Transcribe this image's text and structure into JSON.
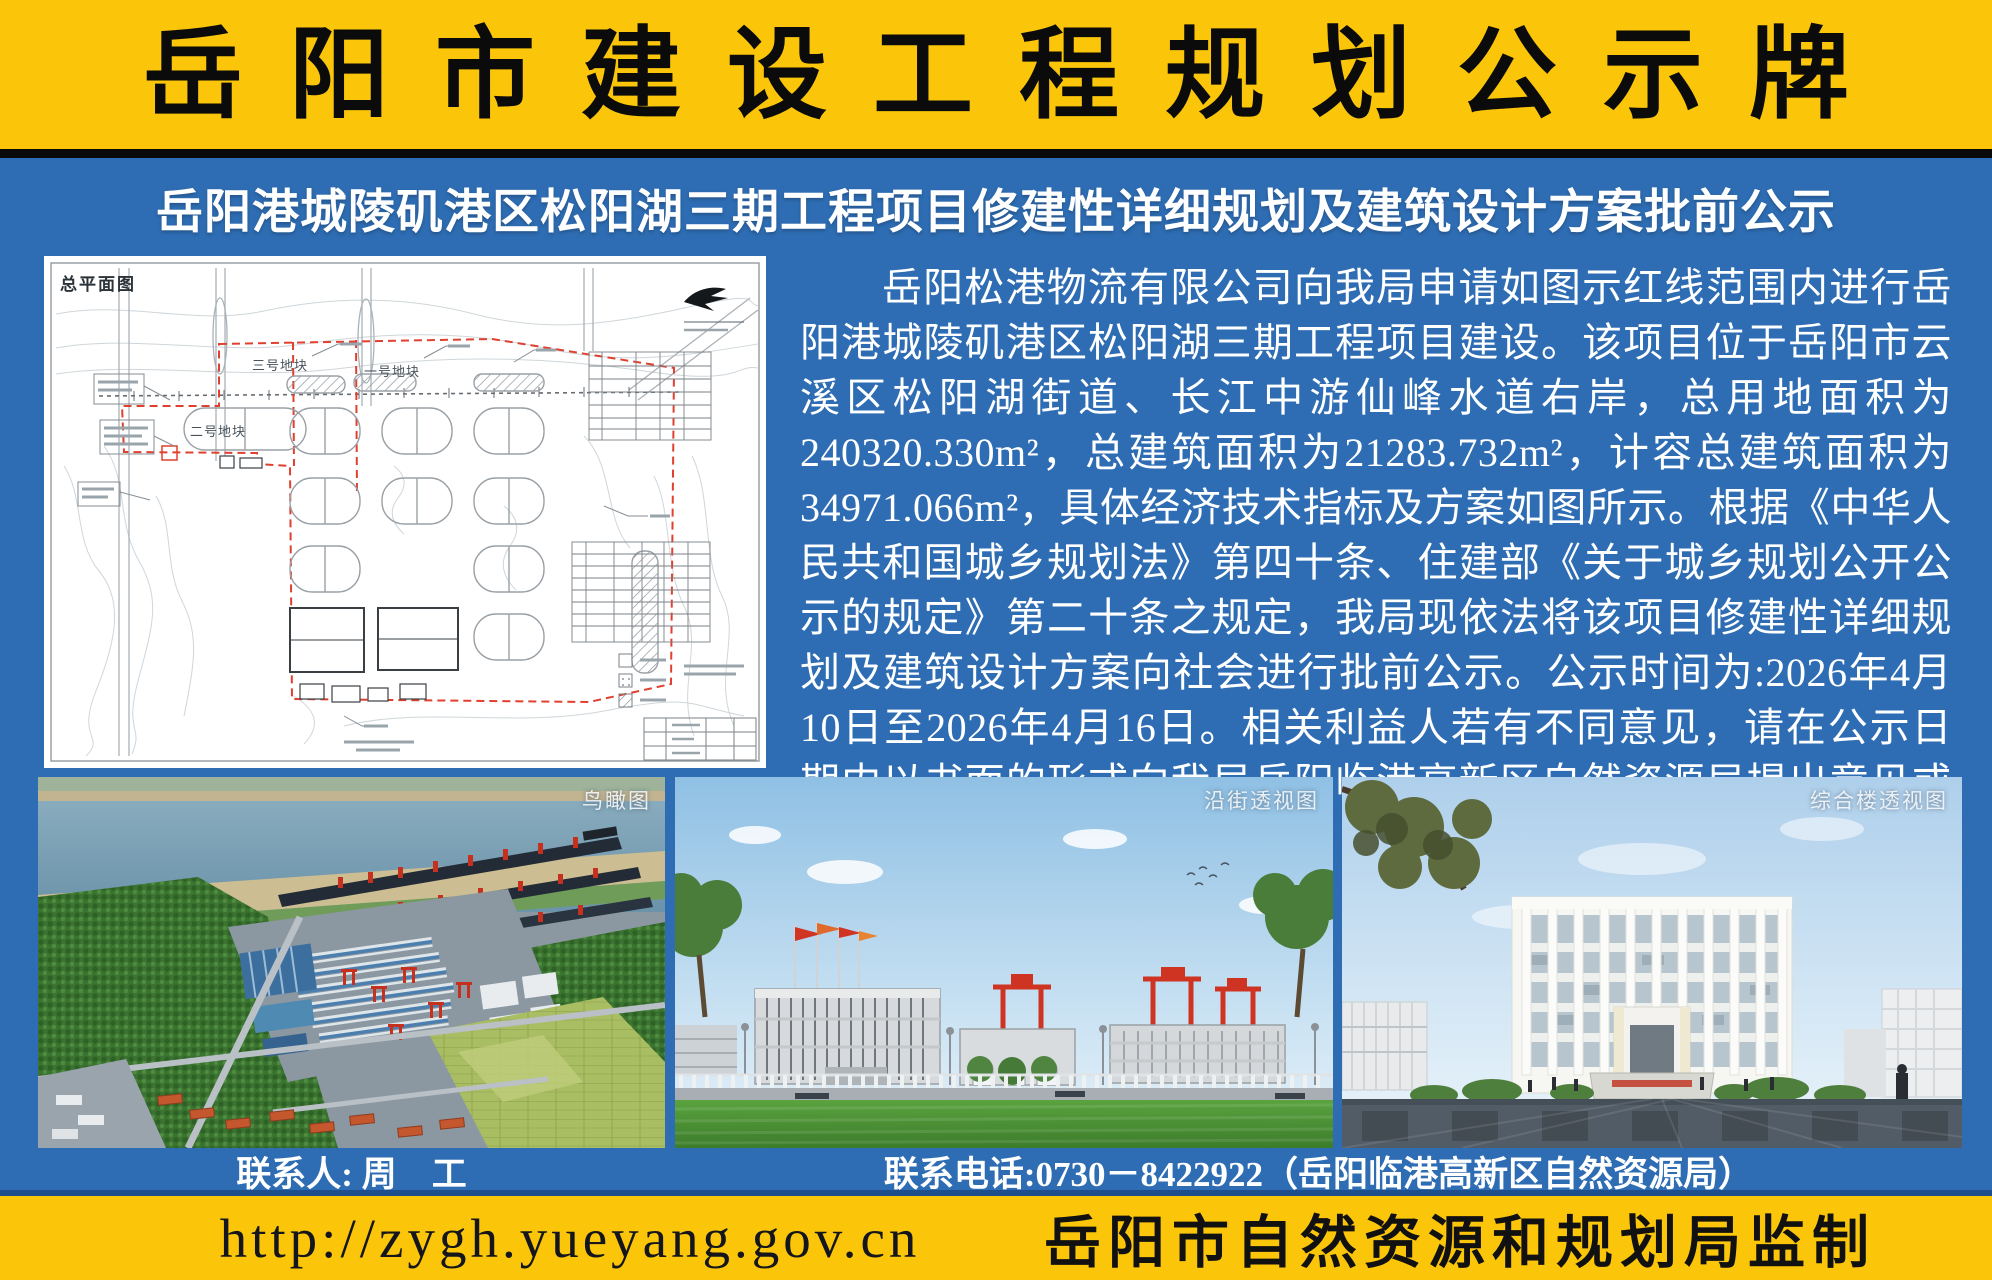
{
  "colors": {
    "banner_yellow": "#FBC60A",
    "board_blue": "#2E6DB3",
    "divider_black": "#0A0A0A",
    "divider_navy": "#1F4E8C",
    "text_white": "#FFFFFF",
    "footer_text_black": "#14161C",
    "red_boundary_line": "#E0402F"
  },
  "banner": {
    "title": "岳阳市建设工程规划公示牌"
  },
  "subtitle": "岳阳港城陵矶港区松阳湖三期工程项目修建性详细规划及建筑设计方案批前公示",
  "site_plan": {
    "title": "总平面图",
    "parcel_labels": [
      "三号地块",
      "一号地块",
      "二号地块"
    ]
  },
  "notice": {
    "text": "岳阳松港物流有限公司向我局申请如图示红线范围内进行岳阳港城陵矶港区松阳湖三期工程项目建设。该项目位于岳阳市云溪区松阳湖街道、长江中游仙峰水道右岸，总用地面积为240320.330m²，总建筑面积为21283.732m²，计容总建筑面积为34971.066m²，具体经济技术指标及方案如图所示。根据《中华人民共和国城乡规划法》第四十条、住建部《关于城乡规划公开公示的规定》第二十条之规定，我局现依法将该项目修建性详细规划及建筑设计方案向社会进行批前公示。公示时间为:2026年4月10日至2026年4月16日。相关利益人若有不同意见，请在公示日期内以书面的形式向我局岳阳临港高新区自然资源局提出意见或建议，逾期我局不再受理。"
  },
  "renders": {
    "aerial_label": "鸟瞰图",
    "street_label": "沿街透视图",
    "tower_label": "综合楼透视图"
  },
  "contacts": {
    "person": "联系人: 周　工",
    "phone": "联系电话:0730－8422922（岳阳临港高新区自然资源局）"
  },
  "footer": {
    "url": "http://zygh.yueyang.gov.cn",
    "supervisor": "岳阳市自然资源和规划局监制"
  }
}
